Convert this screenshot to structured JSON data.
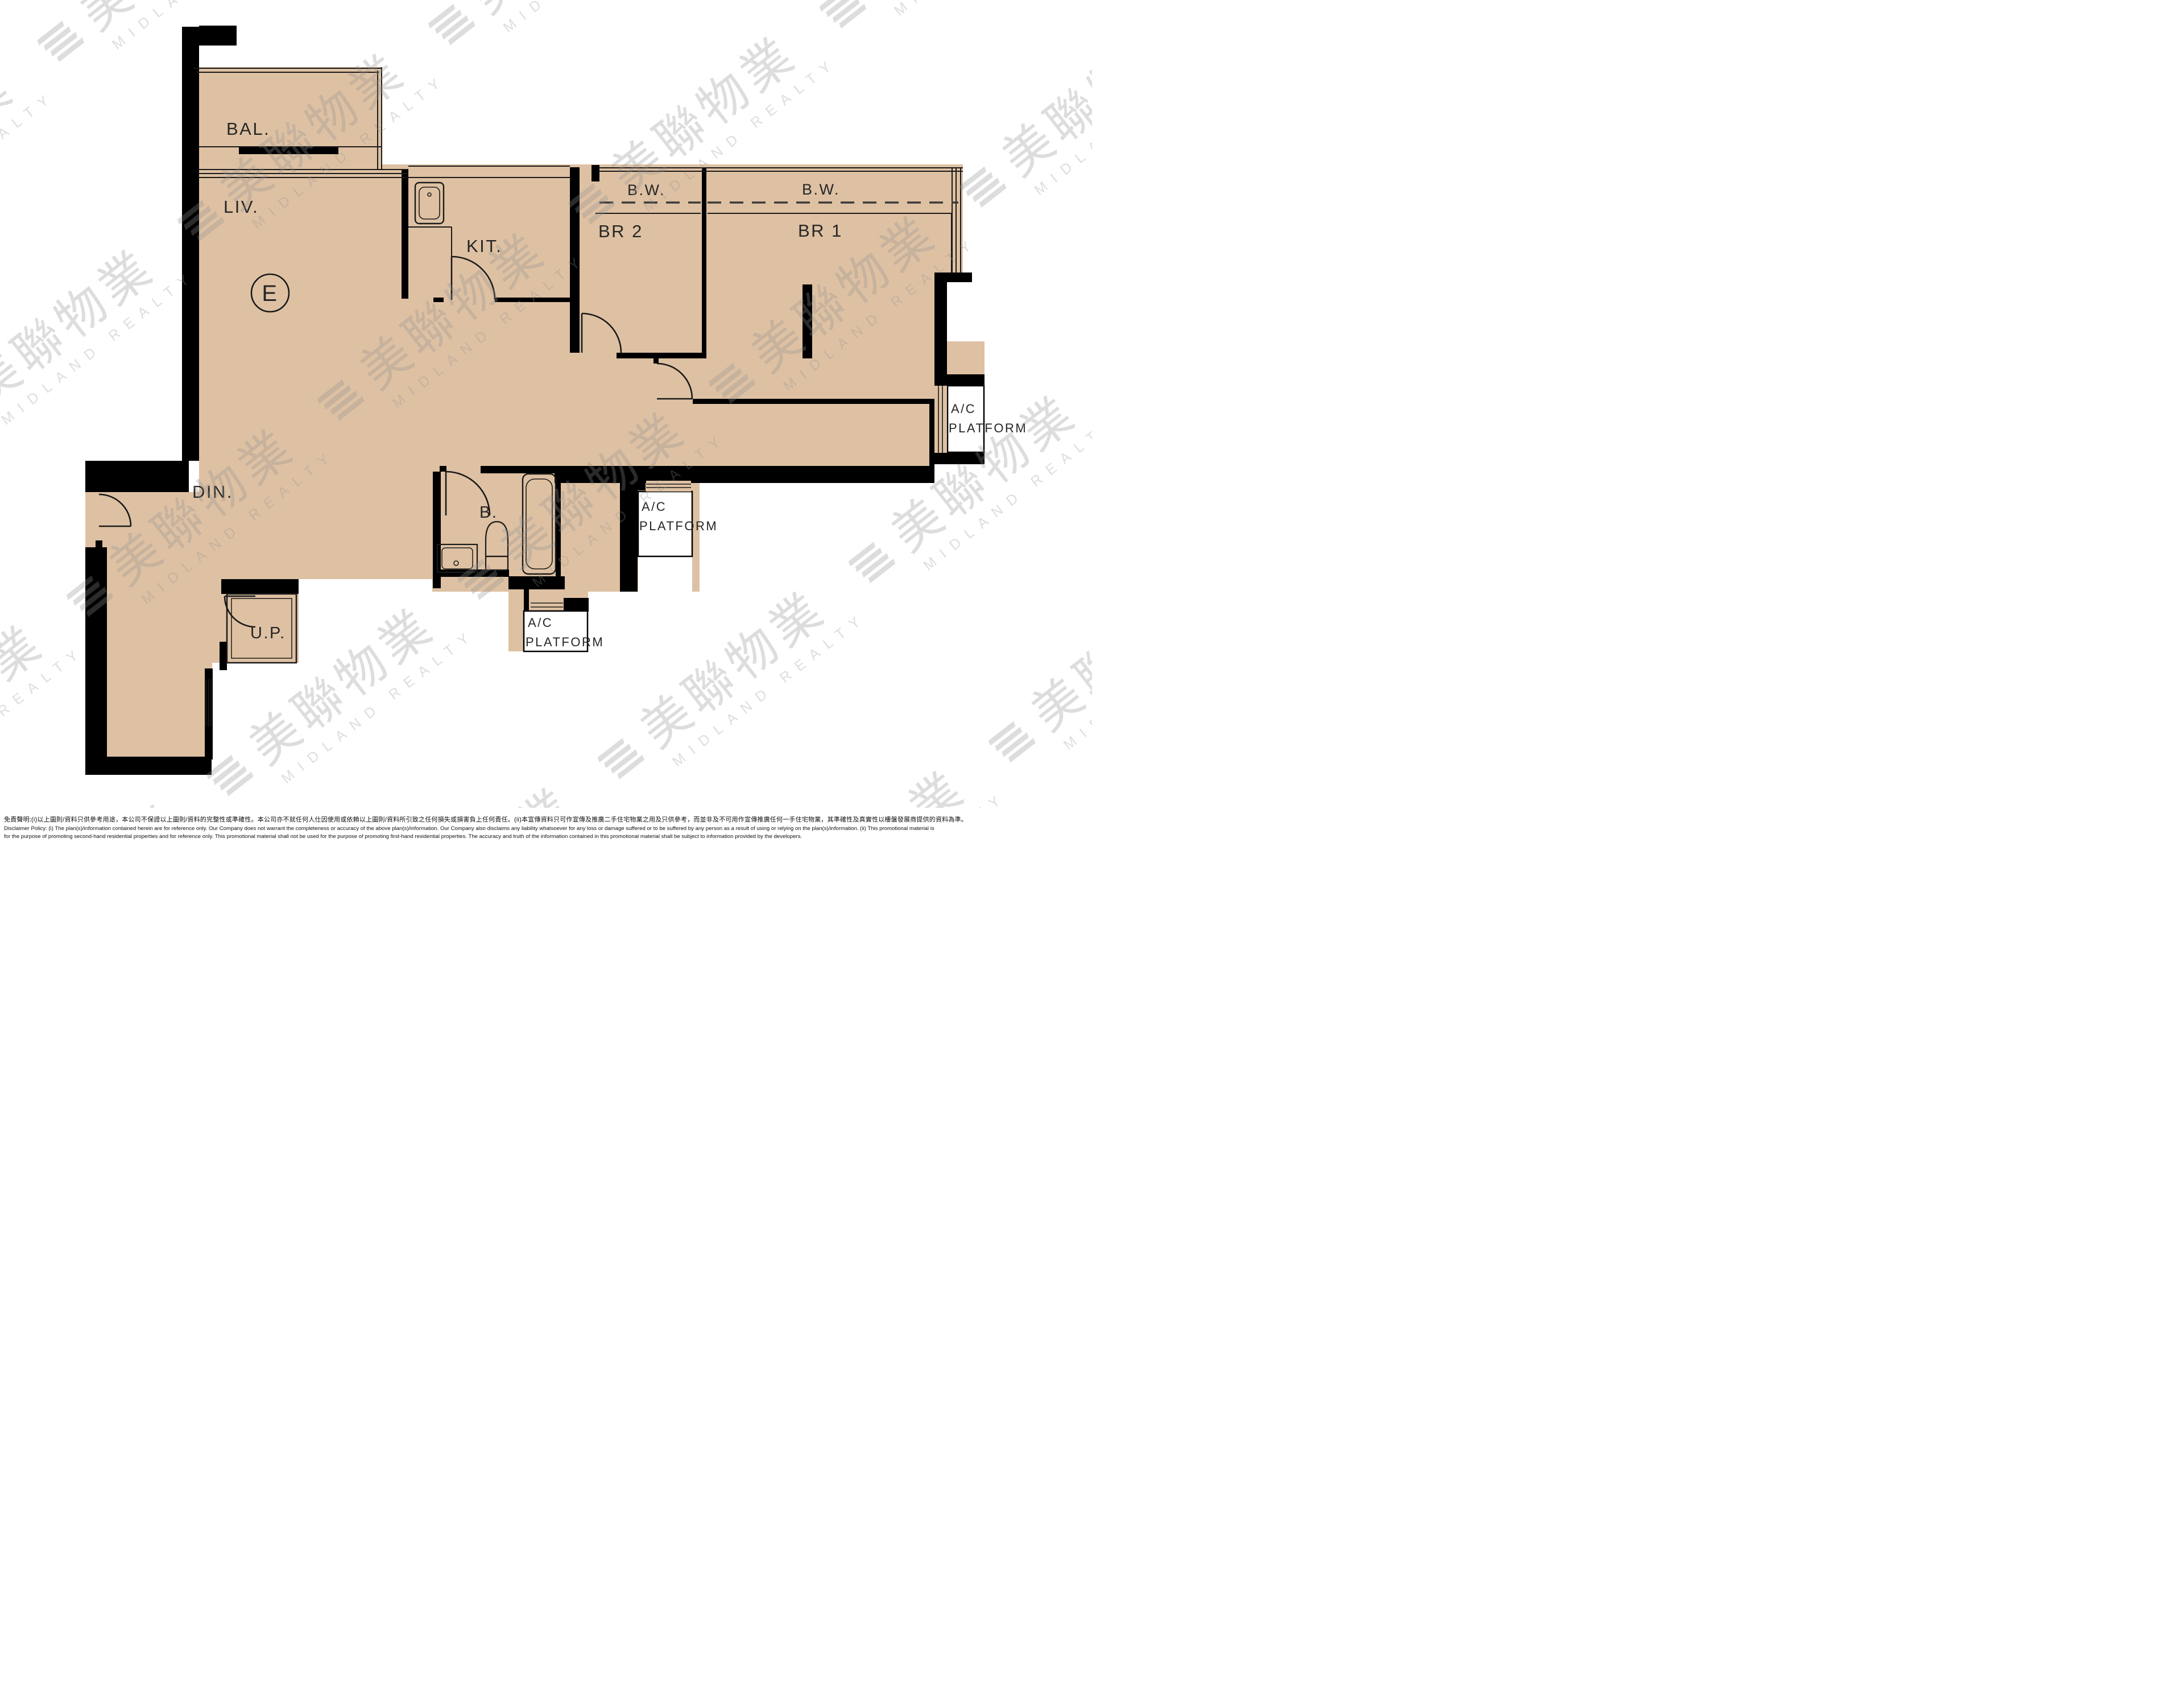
{
  "floorplan": {
    "unit_label": "E",
    "rooms": {
      "bal": "BAL.",
      "liv": "LIV.",
      "kit": "KIT.",
      "din": "DIN.",
      "br2": "BR 2",
      "br1": "BR 1",
      "bath": "B.",
      "up": "U.P."
    },
    "bw_label": "B.W.",
    "ac_line1": "A/C",
    "ac_line2": "PLATFORM",
    "colors": {
      "floor": "#dec1a3",
      "wall": "#000000",
      "line": "#1a1a1a",
      "platform_floor": "#ffffff"
    }
  },
  "watermark": {
    "cn": "美聯物業",
    "en": "MIDLAND REALTY"
  },
  "disclaimer": {
    "zh": "免責聲明:(i)以上圖則/資料只供參考用途，本公司不保證以上圖則/資料的完整性或準確性。本公司亦不就任何人仕因使用或依賴以上圖則/資料所引致之任何損失或損害負上任何責任。(ii)本宣傳資料只可作宣傳及推廣二手住宅物業之用及只供參考，而並非及不可用作宣傳推廣任何一手住宅物業，其準確性及真實性以樓盤發展商提供的資料為準。",
    "en_line1": "Disclaimer Policy: (i) The plan(s)/information contained herein are for reference only. Our Company does not warrant the completeness or accuracy of the above plan(s)/information. Our Company also disclaims any liability whatsoever for any loss or damage suffered or to be suffered by any person as a result of using or relying on the plan(s)/information. (ii) This promotional material is",
    "en_line2": "for the purpose of promoting second-hand residential properties and for reference only. This promotional material shall not be used for the purpose of promoting first-hand residential properties. The accuracy and truth of the information contained in this promotional material shall be subject to information provided by the developers."
  }
}
